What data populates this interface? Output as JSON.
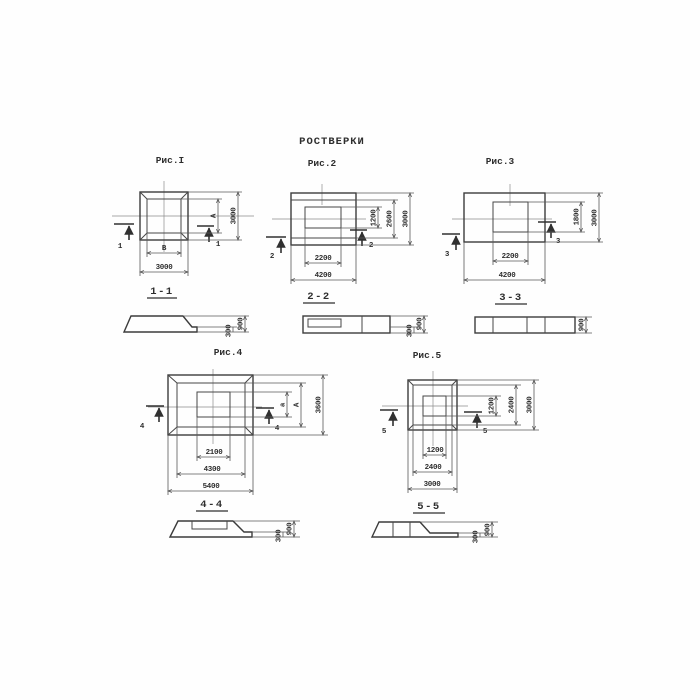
{
  "title": "РОСТВЕРКИ",
  "fig1": {
    "label": "Рис.I",
    "marker": "1",
    "section": "1-1",
    "dim_inner_v": "A",
    "dim_outer_v": "3000",
    "dim_inner_h": "B",
    "dim_outer_h": "3000",
    "sec_total": "900",
    "sec_edge": "300"
  },
  "fig2": {
    "label": "Рис.2",
    "marker": "2",
    "section": "2-2",
    "dim_v": [
      "1200",
      "2600",
      "3000"
    ],
    "dim_h": [
      "2200",
      "4200"
    ],
    "sec_total": "900",
    "sec_edge": "300"
  },
  "fig3": {
    "label": "Рис.3",
    "marker": "3",
    "section": "3-3",
    "dim_v": [
      "1800",
      "3000"
    ],
    "dim_h": [
      "2200",
      "4200"
    ],
    "sec_total": "900"
  },
  "fig4": {
    "label": "Рис.4",
    "marker": "4",
    "section": "4-4",
    "dim_v": [
      "a",
      "A",
      "3600"
    ],
    "dim_h": [
      "2100",
      "4300",
      "5400"
    ],
    "sec_total": "900",
    "sec_edge": "300"
  },
  "fig5": {
    "label": "Рис.5",
    "marker": "5",
    "section": "5-5",
    "dim_v": [
      "1200",
      "2400",
      "3000"
    ],
    "dim_h": [
      "1200",
      "2400",
      "3000"
    ],
    "sec_total": "900",
    "sec_edge": "300"
  }
}
